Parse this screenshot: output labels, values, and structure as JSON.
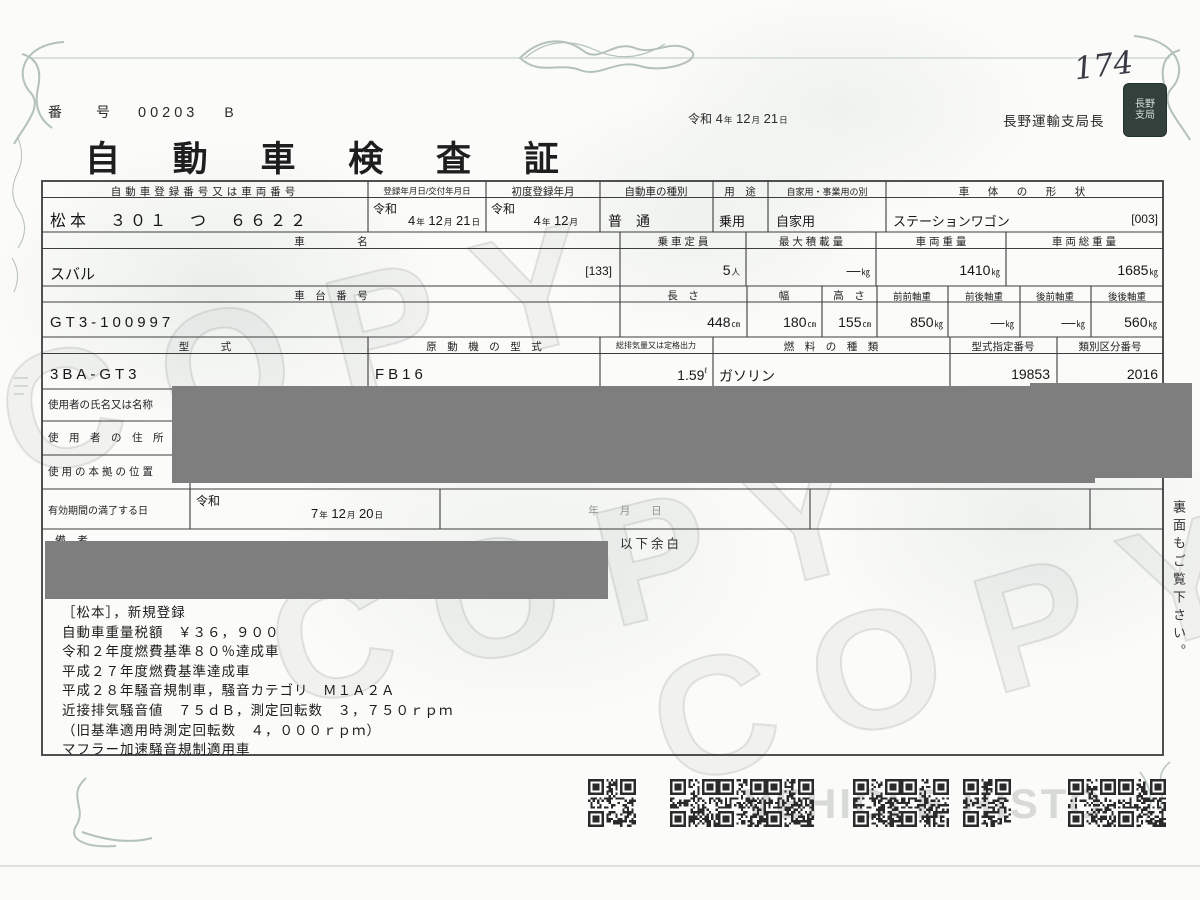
{
  "units": {
    "year": "年",
    "month": "月",
    "day": "日",
    "kg": "㎏",
    "cm": "㎝",
    "person": "人",
    "liter": "ℓ"
  },
  "header": {
    "page_number": "174",
    "doc_no_label": "番　号",
    "doc_no": "00203",
    "doc_no_suffix": "B",
    "title": "自 動 車 検 査 証",
    "issue_era": "令和",
    "issue_y": "4",
    "issue_m": "12",
    "issue_d": "21",
    "issuer": "長野運輸支局長",
    "seal_line1": "長野",
    "seal_line2": "支局"
  },
  "registration": {
    "h_reg_no": "自動車登録番号又は車両番号",
    "h_reg_date": "登録年月日/交付年月日",
    "h_first_reg": "初度登録年月",
    "h_kind": "自動車の種別",
    "h_use": "用　途",
    "h_private": "自家用・事業用の別",
    "h_body": "車　体　の　形　状",
    "reg_no": "松本　３０１　つ　６６２２",
    "reg_era": "令和",
    "reg_y": "4",
    "reg_m": "12",
    "reg_d": "21",
    "first_era": "令和",
    "first_y": "4",
    "first_m": "12",
    "kind": "普　通",
    "use": "乗用",
    "private": "自家用",
    "body": "ステーションワゴン",
    "body_code": "[003]"
  },
  "vehicle": {
    "h_name": "車　　　　　名",
    "name": "スバル",
    "name_code": "[133]",
    "h_capacity": "乗 車 定 員",
    "capacity": "5",
    "h_max_load": "最 大 積 載 量",
    "max_load": "―",
    "h_weight": "車 両 重 量",
    "weight": "1410",
    "h_gross": "車 両 総 重 量",
    "gross": "1685",
    "h_chassis": "車　台　番　号",
    "chassis": "GT3-100997",
    "h_length": "長　さ",
    "length": "448",
    "h_width": "幅",
    "width": "180",
    "h_height": "高　さ",
    "height": "155",
    "h_ax_ff": "前前軸重",
    "ax_ff": "850",
    "h_ax_fr": "前後軸重",
    "ax_fr": "―",
    "h_ax_rf": "後前軸重",
    "ax_rf": "―",
    "h_ax_rr": "後後軸重",
    "ax_rr": "560",
    "h_model": "型　　　式",
    "model": "3BA-GT3",
    "h_engine": "原　動　機　の　型　式",
    "engine": "FB16",
    "h_disp": "総排気量又は定格出力",
    "disp": "1.59",
    "h_fuel": "燃　料　の　種　類",
    "fuel": "ガソリン",
    "h_type_no": "型式指定番号",
    "type_no": "19853",
    "h_class_no": "類別区分番号",
    "class_no": "2016"
  },
  "user": {
    "h_name": "使用者の氏名又は名称",
    "h_address": "使　用　者　の　住　所",
    "h_base": "使用の本拠の位置",
    "h_expiry": "有効期間の満了する日",
    "exp_era": "令和",
    "exp_y": "7",
    "exp_m": "12",
    "exp_d": "20",
    "date_placeholder": "年　　月　　日"
  },
  "remarks": {
    "h_label": "備　考",
    "blank_note": "以下余白",
    "lines": [
      "［松本］，新規登録",
      "自動車重量税額　￥３６，９００",
      "令和２年度燃費基準８０％達成車",
      "平成２７年度燃費基準達成車",
      "平成２８年騒音規制車，騒音カテゴリ　Ｍ１Ａ２Ａ",
      "近接排気騒音値　７５ｄＢ，測定回転数　３，７５０ｒｐｍ",
      "（旧基準適用時測定回転数　４，０００ｒｐｍ）",
      "マフラー加速騒音規制適用車"
    ]
  },
  "footer": {
    "side_note": "裏面もご覧下さい。",
    "watermark_copy": "COPY",
    "watermark_veh": "VEHICLE HISTO"
  }
}
